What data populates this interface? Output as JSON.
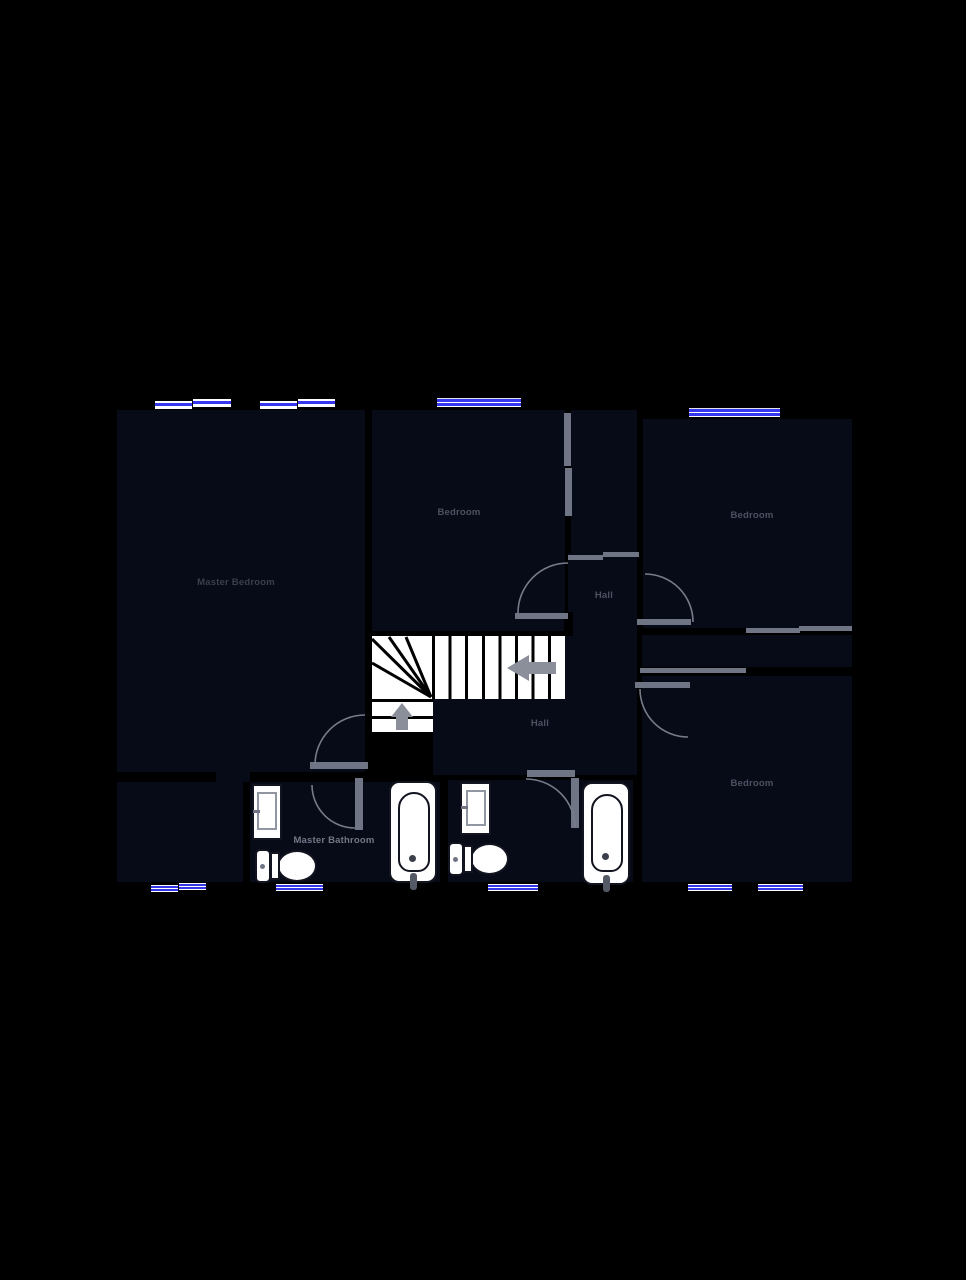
{
  "plan": {
    "type": "floor-plan",
    "colors": {
      "background": "#000000",
      "room_fill": "#070a17",
      "door_gray": "#6f7585",
      "window_blue": "#3636ee",
      "fixture_white": "#ffffff",
      "arrow_gray": "#8a8f99"
    },
    "rooms": {
      "master_bedroom": {
        "label": "Master Bedroom"
      },
      "bedroom_top_middle": {
        "label": "Bedroom"
      },
      "bedroom_top_right": {
        "label": "Bedroom"
      },
      "bedroom_bottom_right": {
        "label": "Bedroom"
      },
      "hall_upper": {
        "label": "Hall"
      },
      "hall_lower": {
        "label": "Hall"
      },
      "master_bathroom": {
        "label": "Master Bathroom"
      }
    },
    "fixtures": [
      "sink",
      "toilet",
      "bathtub",
      "sink",
      "toilet",
      "bathtub"
    ],
    "stairs": {
      "direction_arrows": [
        "up",
        "left"
      ]
    },
    "window_count": 10,
    "door_count": 8
  }
}
